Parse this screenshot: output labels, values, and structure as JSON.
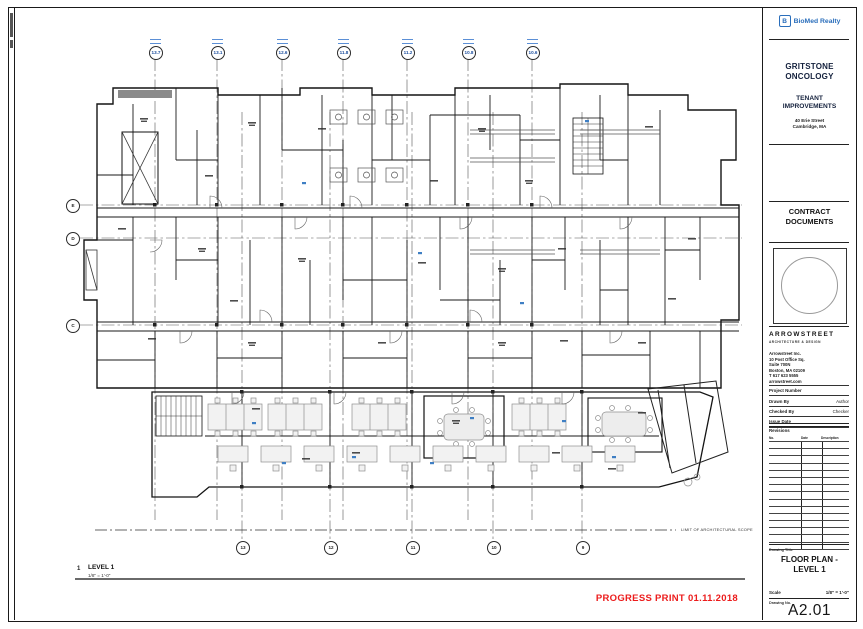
{
  "sheet": {
    "progress_print": "PROGRESS PRINT 01.11.2018",
    "progress_print_color": "#ec1c1c",
    "scope_note": "LIMIT OF ARCHITECTURAL SCOPE",
    "view_title": {
      "number": "1",
      "name": "LEVEL 1",
      "scale": "1/8\" = 1'-0\""
    },
    "grid": {
      "top_bubbles": [
        {
          "label": "13.7",
          "x": 155
        },
        {
          "label": "13.1",
          "x": 217
        },
        {
          "label": "12.6",
          "x": 282
        },
        {
          "label": "11.8",
          "x": 343
        },
        {
          "label": "11.2",
          "x": 407
        },
        {
          "label": "10.8",
          "x": 468
        },
        {
          "label": "10.6",
          "x": 532
        }
      ],
      "bottom_bubbles": [
        {
          "label": "13",
          "x": 242
        },
        {
          "label": "12",
          "x": 330
        },
        {
          "label": "11",
          "x": 412
        },
        {
          "label": "10",
          "x": 493
        },
        {
          "label": "9",
          "x": 582
        }
      ],
      "left_bubbles": [
        {
          "label": "E",
          "y": 205
        },
        {
          "label": "D",
          "y": 238
        },
        {
          "label": "C",
          "y": 325
        }
      ]
    }
  },
  "title_block": {
    "brand": {
      "name": "BioMed Realty",
      "icon_letter": "B",
      "color": "#2a6ebb"
    },
    "client": "GRITSTONE ONCOLOGY",
    "project": "TENANT IMPROVEMENTS",
    "address": [
      "40 Erie Street",
      "Cambridge, MA"
    ],
    "phase": "CONTRACT DOCUMENTS",
    "architect": {
      "name": "ARROWSTREET",
      "tagline": "ARCHITECTURE & DESIGN",
      "address_lines": [
        "Arrowstreet Inc.",
        "10 Post Office Sq.",
        "Suite 700N",
        "Boston, MA 02109",
        "T 617 623 5555",
        "arrowstreet.com"
      ]
    },
    "info_rows": [
      {
        "label": "Project Number",
        "value": ""
      },
      {
        "label": "Drawn By",
        "value": "Author"
      },
      {
        "label": "Checked By",
        "value": "Checker"
      },
      {
        "label": "Issue Date",
        "value": ""
      }
    ],
    "revisions": {
      "label": "Revisions",
      "columns": [
        "No.",
        "Date",
        "Description"
      ],
      "row_count": 15
    },
    "drawing_title_label": "Drawing Title",
    "drawing_title": "FLOOR PLAN - LEVEL 1",
    "scale_label": "Scale",
    "scale_value": "1/8\" = 1'-0\"",
    "drawing_no_label": "Drawing No.",
    "drawing_no": "A2.01"
  }
}
